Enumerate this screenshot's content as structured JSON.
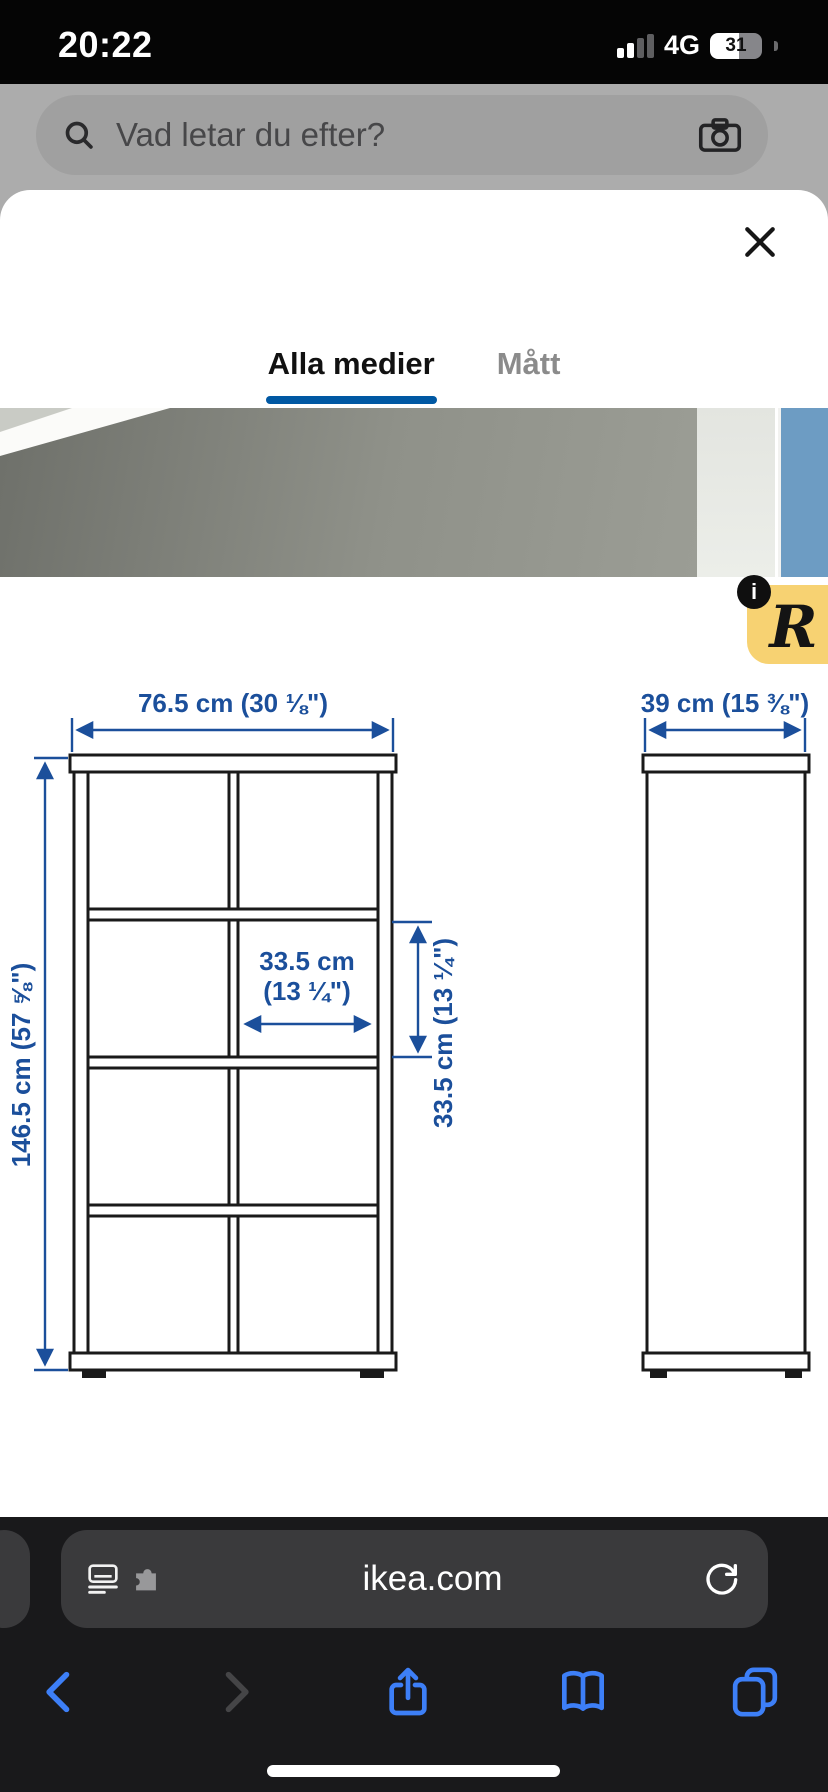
{
  "status_bar": {
    "time": "20:22",
    "network": "4G",
    "battery_percent": "31"
  },
  "search": {
    "placeholder": "Vad letar du efter?"
  },
  "sheet": {
    "tabs": [
      {
        "label": "Alla medier",
        "active": true
      },
      {
        "label": "Mått",
        "active": false
      }
    ]
  },
  "overlay": {
    "info_glyph": "i",
    "partner_glyph": "R"
  },
  "diagram": {
    "product": "KALLAX shelving unit dimension drawing",
    "width_label": "76.5 cm (30 ⅛\")",
    "height_label": "146.5 cm (57 ⅝\")",
    "depth_label": "39 cm (15 ⅜\")",
    "cell_width_line1": "33.5 cm",
    "cell_width_line2": "(13 ¼\")",
    "cell_height_label": "33.5 cm (13 ¼\")"
  },
  "browser": {
    "url": "ikea.com"
  },
  "colors": {
    "ikea_accent_blue": "#0058a3",
    "dimension_blue": "#1b4f9b",
    "badge_yellow": "#f7d272",
    "ios_blue": "#3d7ff7",
    "bar_background": "#19191b",
    "photo_next_blue": "#6d9cc3"
  }
}
